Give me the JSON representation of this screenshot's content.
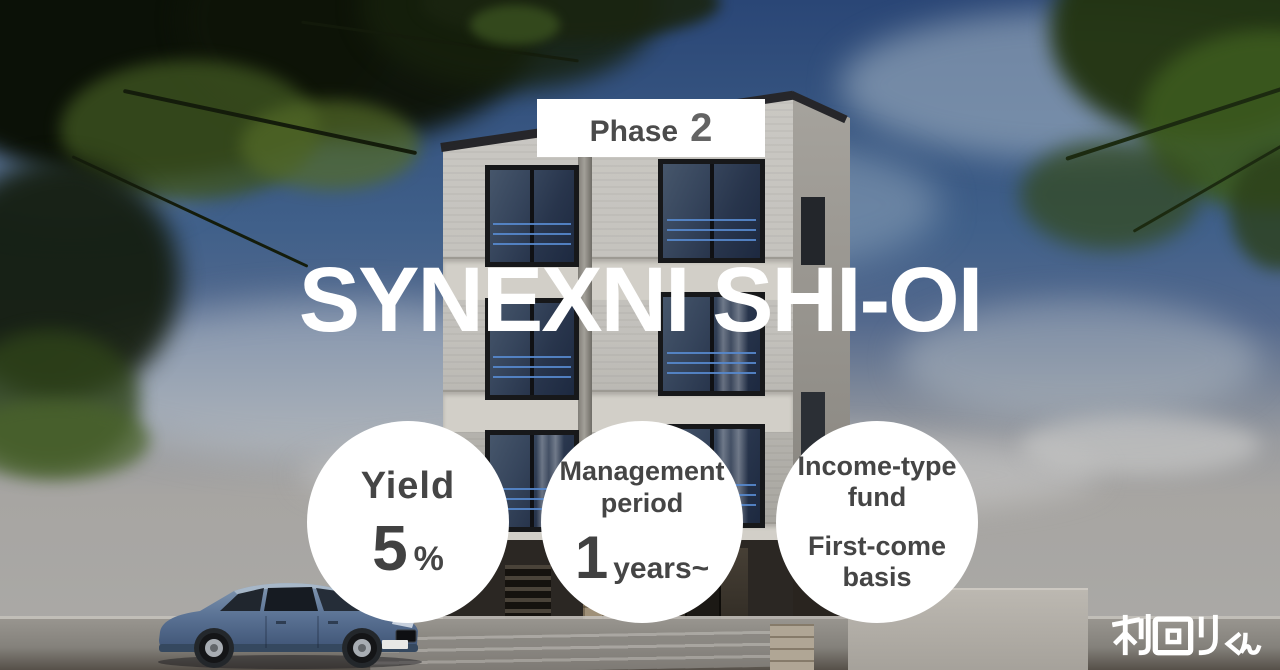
{
  "badge": {
    "label": "Phase",
    "number": "2"
  },
  "hero": {
    "title": "SYNEXNI SHI-OI"
  },
  "circles": {
    "yield": {
      "label": "Yield",
      "value": "5",
      "unit": "%"
    },
    "period": {
      "label": "Management period",
      "value": "1",
      "unit": "years~"
    },
    "fund": {
      "line1": "Income-type fund",
      "line2": "First-come basis"
    }
  },
  "logo": {
    "text": "利回りくん"
  },
  "colors": {
    "circle_text": "#454545",
    "badge_text": "#4b4b4b",
    "title_text": "#ffffff",
    "railing_blue": "#4a78b8",
    "sky_top": "#2a4676"
  }
}
